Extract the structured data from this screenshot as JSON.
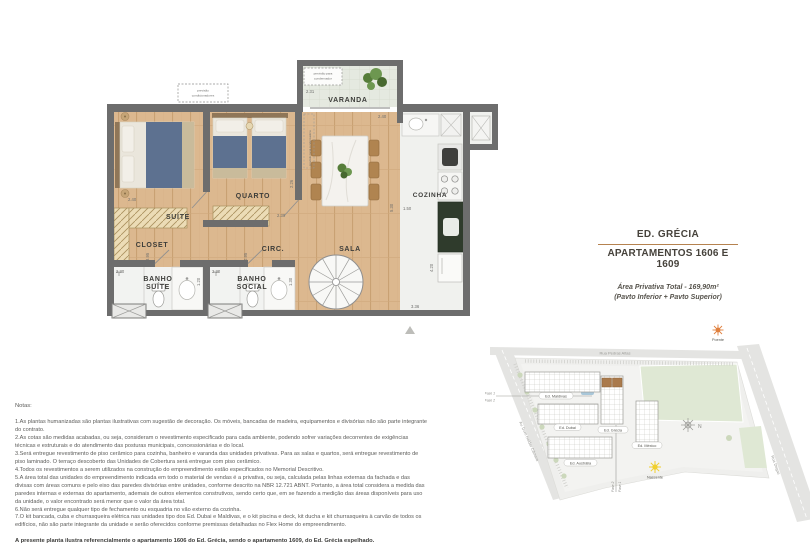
{
  "title_block": {
    "building": "ED. GRÉCIA",
    "apartments": "APARTAMENTOS 1606 E 1609",
    "area1": "Área Privativa Total - 169,90m²",
    "area2": "(Pavto Inferior + Pavto Superior)",
    "accent_color": "#b5824f"
  },
  "floor_plan": {
    "rooms": {
      "suite": "SUÍTE",
      "closet": "CLOSET",
      "quarto": "QUARTO",
      "circ": "CIRC.",
      "sala": "SALA",
      "cozinha": "COZINHA",
      "varanda": "VARANDA",
      "banho_suite": [
        "BANHO",
        "SUÍTE"
      ],
      "banho_social": [
        "BANHO",
        "SOCIAL"
      ]
    },
    "annotations": {
      "conditioners": [
        "previsão",
        "condicionadores"
      ],
      "condenser": [
        "previsão para",
        "condensador"
      ],
      "local": "previsão local condensadora"
    },
    "dims": {
      "suite_w": "2.40",
      "varanda_w": "2.31",
      "varanda_d": "0.90",
      "sala_top": "2.40",
      "quarto_w": "2.30",
      "quarto_d": "2.26",
      "sala_h": "5.30",
      "cozinha_w": "1.50",
      "cozinha_h": "4.20",
      "bottom": "3.36",
      "bs_w": "2.30",
      "bs_d": "1.20",
      "bsoc_w": "2.30",
      "bsoc_d": "1.30",
      "circ_w": "0.95",
      "closet_h": "3.95"
    },
    "wall_color": "#6d6d6d",
    "wood_color": "#dcb88f"
  },
  "site_map": {
    "streets": {
      "top": "Rua Pedras Altas",
      "left": "Av. Dom Helder Câmara",
      "right": "Rua Degas"
    },
    "buildings": {
      "maldivas": "Ed. Maldivas",
      "dubai": "Ed. Dubai",
      "grecia": "Ed. Grécia",
      "mexico": "Ed. México",
      "australia": "Ed. Austrália"
    },
    "phases": {
      "fase1": "Fase 1",
      "fase2": "Fase 2"
    },
    "suns": {
      "west": "Poente",
      "east": "Nascente"
    },
    "compass": "N",
    "highlight_color": "#aa7a4c"
  },
  "notes": {
    "heading": "Notas:",
    "items": [
      "1.As plantas humanizadas são plantas ilustrativas com sugestão de decoração. Os móveis, bancadas de madeira, equipamentos e divisórias não são parte integrante do contrato.",
      "2.As cotas são medidas acabadas, ou seja, consideram o revestimento especificado para cada ambiente, podendo sofrer variações decorrentes de exigências técnicas e estruturais e do atendimento das posturas municipais, concessionárias e do local.",
      "3.Será entregue revestimento de piso cerâmico para cozinha, banheiro e varanda das unidades privativas. Para as salas e quartos, será entregue revestimento de piso laminado. O terraço descoberto das Unidades de Cobertura será entregue com piso cerâmico.",
      "4.Todos os revestimentos a serem utilizados na construção do empreendimento estão especificados no Memorial Descritivo.",
      "5.A área total das unidades do empreendimento indicada em todo o material de vendas é a privativa, ou seja, calculada pelas linhas externas da fachada e das divisas com áreas comuns e pelo eixo das paredes divisórias entre unidades, conforme descrito na NBR 12.721 ABNT. Portanto, a área total considera a medida das paredes internas e externas do apartamento, ademais de outros elementos construtivos, sendo certo que, em se fazendo a medição das áreas disponíveis para uso da unidade, o valor encontrado será menor que o valor da área total.",
      "6.Não será entregue qualquer tipo de fechamento ou esquadria no vão externo da cozinha.",
      "7.O kit bancada, cuba e churrasqueira elétrica nas unidades tipo dos Ed. Dubai e Maldivas, e o kit piscina e deck, kit ducha e kit churrasqueira à carvão de todos os edifícios, não são parte integrante da unidade e serão oferecidos conforme premissas detalhadas no Flex Home do empreendimento."
    ],
    "footer": "A presente planta ilustra referencialmente o apartamento 1606 do Ed. Grécia, sendo o apartamento 1609, do Ed. Grécia espelhado."
  }
}
